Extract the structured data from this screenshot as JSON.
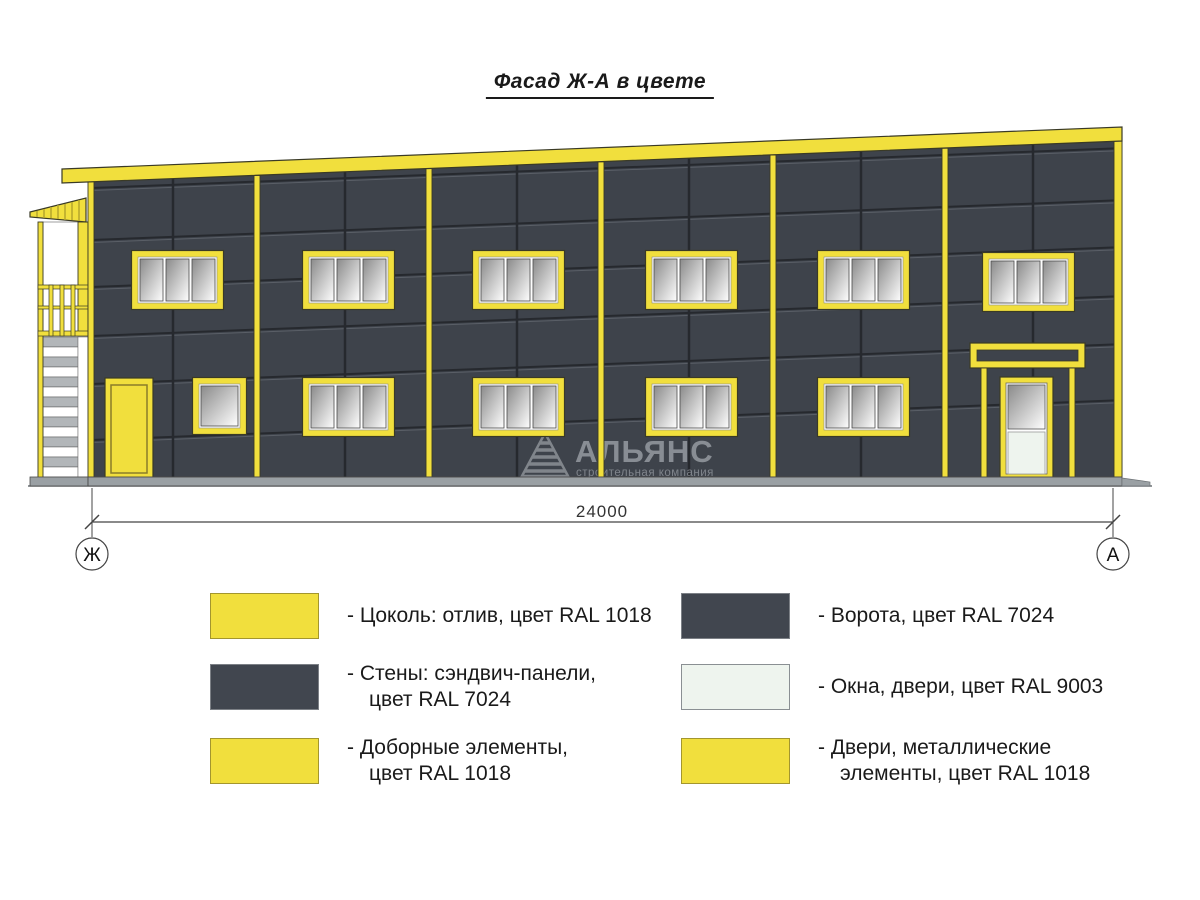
{
  "title": "Фасад Ж-А в цвете",
  "drawing": {
    "dimension_value": "24000",
    "axis_left_label": "Ж",
    "axis_right_label": "А"
  },
  "watermark": {
    "name": "АЛЬЯНС",
    "subtitle": "строительная компания"
  },
  "colors": {
    "ral1018": "#f1df3d",
    "ral7024": "#41464f",
    "ral9003": "#eef4ee",
    "wall": "#3e434b",
    "joint": "#26292e",
    "base_gray": "#9aa0a4"
  },
  "legend": {
    "left": [
      {
        "color": "#f1df3d",
        "lines": [
          "- Цоколь: отлив, цвет RAL 1018"
        ]
      },
      {
        "color": "#41464f",
        "lines": [
          "- Стены: сэндвич-панели,",
          "цвет RAL 7024"
        ]
      },
      {
        "color": "#f1df3d",
        "lines": [
          "- Доборные элементы,",
          "цвет RAL 1018"
        ]
      }
    ],
    "right": [
      {
        "color": "#41464f",
        "lines": [
          "- Ворота, цвет RAL 7024"
        ]
      },
      {
        "color": "#eef4ee",
        "lines": [
          "- Окна, двери, цвет RAL 9003"
        ]
      },
      {
        "color": "#f1df3d",
        "lines": [
          "- Двери, металлические",
          "элементы, цвет RAL 1018"
        ]
      }
    ]
  }
}
